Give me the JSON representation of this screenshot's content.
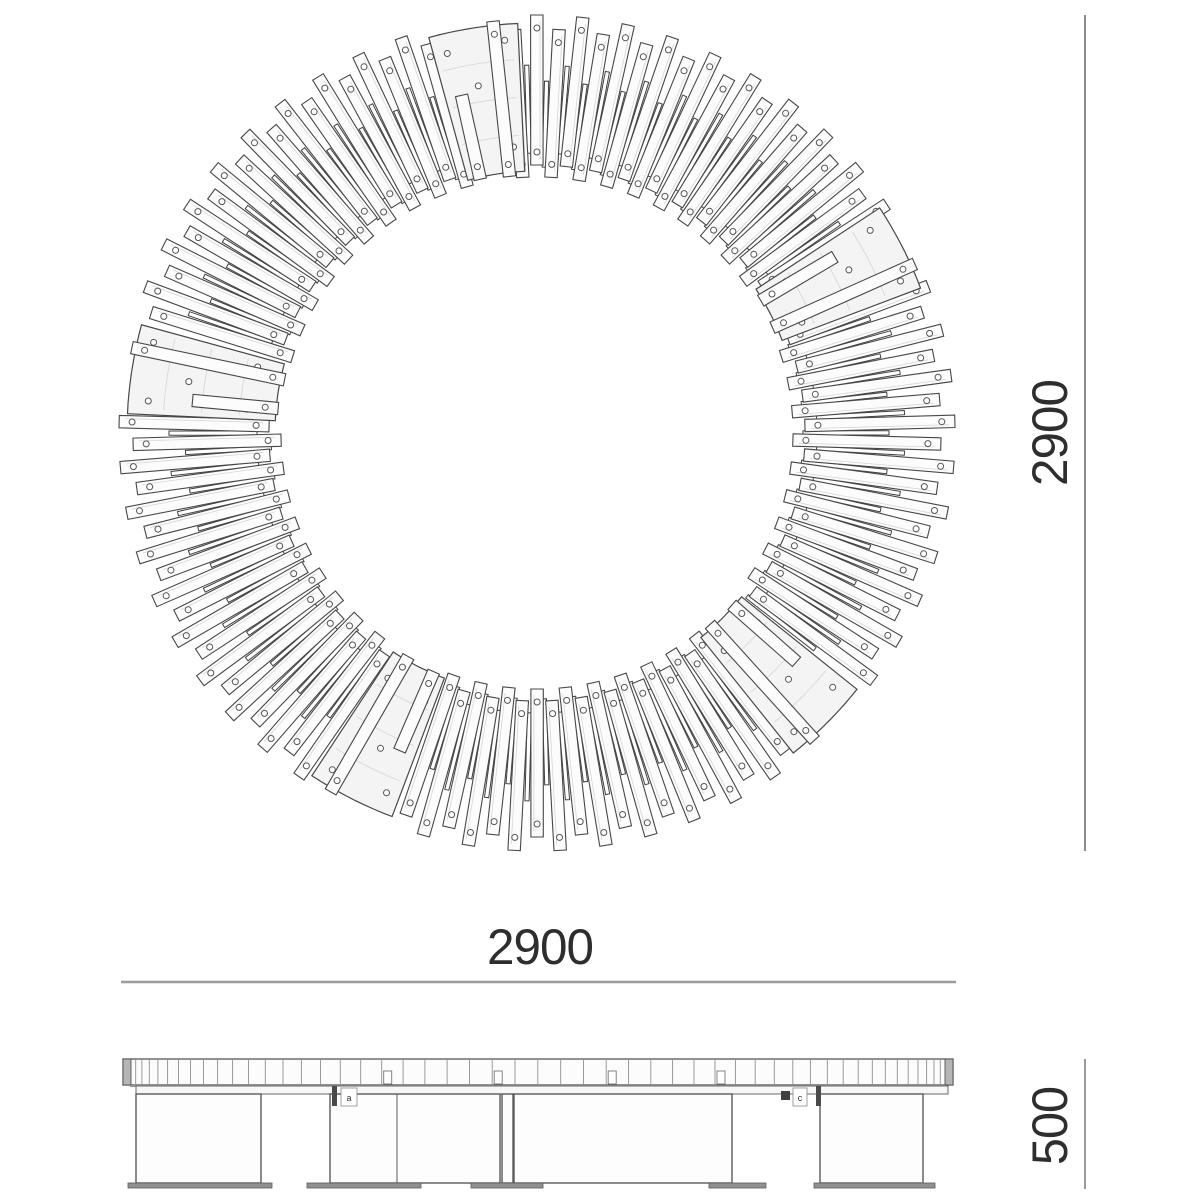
{
  "dimensions": {
    "plan_diameter": {
      "label": "2900"
    },
    "plan_width": {
      "label": "2900"
    },
    "elevation_height": {
      "label": "500"
    }
  },
  "callouts": [
    {
      "label": "a"
    },
    {
      "label": "c"
    }
  ],
  "colors": {
    "outline": "#474747",
    "slat_fill": "#fcfcfc",
    "plate_fill": "#f4f4f4",
    "faint": "#d8d8d8",
    "grain": "#d6d6d6",
    "slot_stroke": "#3f3f3f",
    "hole_stroke": "#555555",
    "tick": "#8f8f8f",
    "leg_stroke": "#5a5a5a",
    "foot_fill": "#919191",
    "cap_fill": "#b5b5b5",
    "rail_fill": "#f7f7f7",
    "rail_stroke": "#6a6a6a",
    "shadow": "#949494",
    "dim_line_dark": "#6e6e6e",
    "dim_line_light": "#9c9c9c",
    "clip_fill": "#4a4a4a",
    "text": "#2e2e2e"
  },
  "plan": {
    "center_x": 537,
    "center_y": 433,
    "slat_count": 114,
    "angle_offset": 1.6,
    "slat_half_width": 6.2,
    "outer_radius_long": 418,
    "outer_radius_short": 404,
    "inner_radius_long": 256,
    "inner_radius_short": 268,
    "hole_radius": 3,
    "hole_inset": 13,
    "slots": {
      "half_width": 2.1,
      "r1_even": 280,
      "r2_even": 368,
      "r1_odd": 266,
      "r2_odd": 352
    },
    "plate_angles_deg": [
      27,
      99,
      171,
      243,
      315
    ],
    "plate_half_span_deg": 6.3,
    "plate_inner_radius": 262,
    "plate_outer_radius": 410,
    "plate_arc_radii": [
      298,
      336,
      374
    ],
    "skip_slat_within_deg": 5.6,
    "skip_slot_within_deg": 7.0
  },
  "elevation": {
    "left": 123,
    "right": 953,
    "seat_top": 1059,
    "seat_bottom": 1085,
    "cap_width": 8,
    "mid_x": 538,
    "tick_radius": 415,
    "tick_top": 1060,
    "tick_bottom": 1084,
    "rail_left": 136,
    "rail_right": 948,
    "rail_top": 1086,
    "rail_height": 8,
    "leg_top": 1094,
    "leg_bottom": 1183,
    "legs": [
      [
        136,
        261
      ],
      [
        330,
        500
      ],
      [
        502,
        513
      ],
      [
        514,
        732
      ],
      [
        820,
        923
      ]
    ],
    "leg_inner_lines": [
      397
    ],
    "feet": [
      [
        128,
        272
      ],
      [
        307,
        421
      ],
      [
        471,
        543
      ],
      [
        709,
        766
      ],
      [
        814,
        935
      ]
    ],
    "foot_top": 1183,
    "foot_height": 5,
    "clips": [
      [
        332,
        1086
      ],
      [
        816,
        1086
      ]
    ],
    "callout_boxes": [
      [
        341,
        1088,
        16,
        18
      ],
      [
        793,
        1088,
        14,
        18
      ]
    ],
    "logo_mark": [
      781,
      1091,
      9,
      9
    ]
  },
  "dim_geometry": {
    "plan_height_line": {
      "x": 1085,
      "y1": 15,
      "y2": 851,
      "width": 1.6
    },
    "plan_width_line": {
      "y": 982,
      "x1": 121,
      "x2": 956,
      "width": 2.4
    },
    "elev_height_line": {
      "x": 1085,
      "y1": 1059,
      "y2": 1189,
      "width": 1.4
    }
  }
}
